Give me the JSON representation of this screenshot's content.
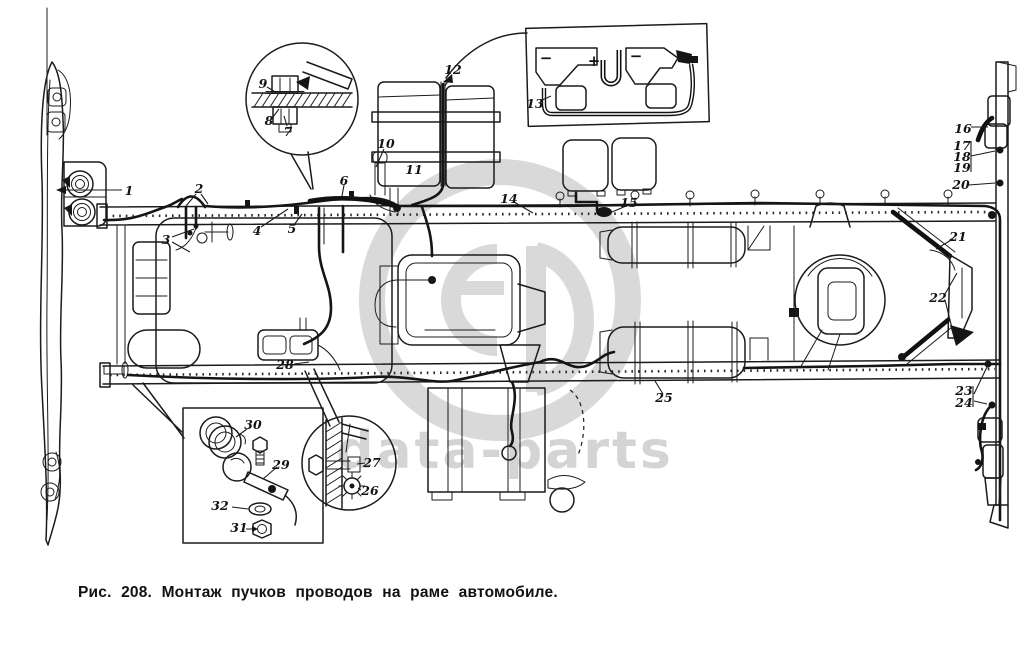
{
  "figure": {
    "caption": "Рис. 208.  Монтаж пучков проводов на раме автомобиле."
  },
  "watermark": {
    "text": "data-parts",
    "logo": "db-monogram-ring",
    "color": "#d9d9d9"
  },
  "diagram": {
    "ink": "#1b1b1b",
    "background": "#ffffff",
    "subject": "truck-frame-wiring-harness-top-view",
    "battery_schematic": {
      "terminals": [
        "−",
        "+",
        "−"
      ]
    },
    "callouts": [
      {
        "n": "1",
        "x": 129,
        "y": 191
      },
      {
        "n": "2",
        "x": 199,
        "y": 189
      },
      {
        "n": "3",
        "x": 166,
        "y": 240
      },
      {
        "n": "4",
        "x": 257,
        "y": 231
      },
      {
        "n": "5",
        "x": 292,
        "y": 229
      },
      {
        "n": "6",
        "x": 344,
        "y": 181
      },
      {
        "n": "7",
        "x": 288,
        "y": 132
      },
      {
        "n": "8",
        "x": 269,
        "y": 121
      },
      {
        "n": "9",
        "x": 263,
        "y": 84
      },
      {
        "n": "10",
        "x": 386,
        "y": 144
      },
      {
        "n": "11",
        "x": 414,
        "y": 170
      },
      {
        "n": "12",
        "x": 453,
        "y": 70
      },
      {
        "n": "13",
        "x": 535,
        "y": 104
      },
      {
        "n": "14",
        "x": 509,
        "y": 199
      },
      {
        "n": "15",
        "x": 629,
        "y": 203
      },
      {
        "n": "16",
        "x": 963,
        "y": 131
      },
      {
        "n": "17",
        "x": 962,
        "y": 147
      },
      {
        "n": "18",
        "x": 962,
        "y": 158
      },
      {
        "n": "19",
        "x": 962,
        "y": 169
      },
      {
        "n": "20",
        "x": 961,
        "y": 187
      },
      {
        "n": "21",
        "x": 958,
        "y": 237
      },
      {
        "n": "22",
        "x": 938,
        "y": 298
      },
      {
        "n": "23",
        "x": 964,
        "y": 392
      },
      {
        "n": "24",
        "x": 964,
        "y": 404
      },
      {
        "n": "25",
        "x": 664,
        "y": 399
      },
      {
        "n": "26",
        "x": 370,
        "y": 492
      },
      {
        "n": "27",
        "x": 372,
        "y": 464
      },
      {
        "n": "28",
        "x": 285,
        "y": 366
      },
      {
        "n": "29",
        "x": 281,
        "y": 465
      },
      {
        "n": "30",
        "x": 253,
        "y": 426
      },
      {
        "n": "31",
        "x": 239,
        "y": 529
      },
      {
        "n": "32",
        "x": 220,
        "y": 507
      }
    ]
  }
}
